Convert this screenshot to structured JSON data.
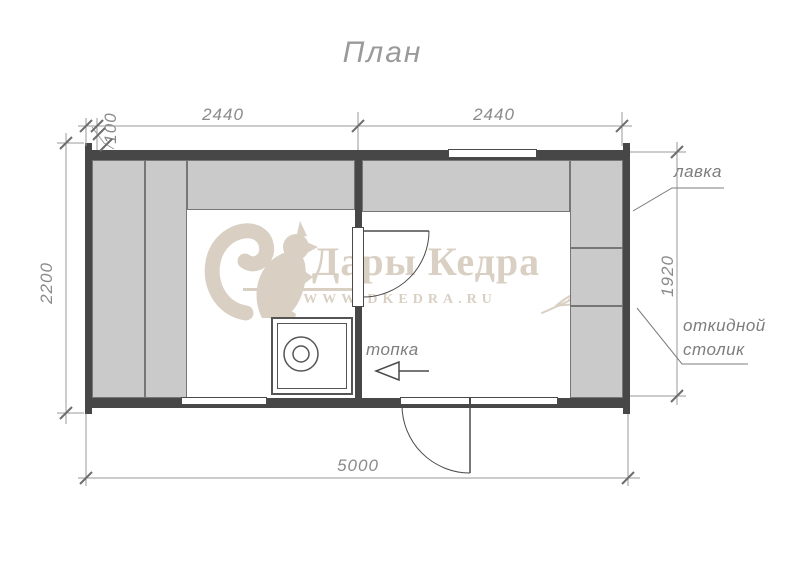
{
  "title": "План",
  "watermark": {
    "brand": "Дары Кедра",
    "website": "WWW.DKEDRA.RU"
  },
  "dimensions_mm": {
    "wall_offset": "100",
    "left_room_width": "2440",
    "right_room_width": "2440",
    "total_width": "5000",
    "total_depth": "2200",
    "right_inner_depth": "1920"
  },
  "annotations": {
    "bench": "лавка",
    "folding_table_line1": "откидной",
    "folding_table_line2": "столик",
    "firebox": "топка"
  },
  "colors": {
    "wall": "#474747",
    "bench_fill": "#cacaca",
    "bench_border": "#767676",
    "dimension_text": "#8a8a8a",
    "watermark": "#d9d0c3"
  }
}
